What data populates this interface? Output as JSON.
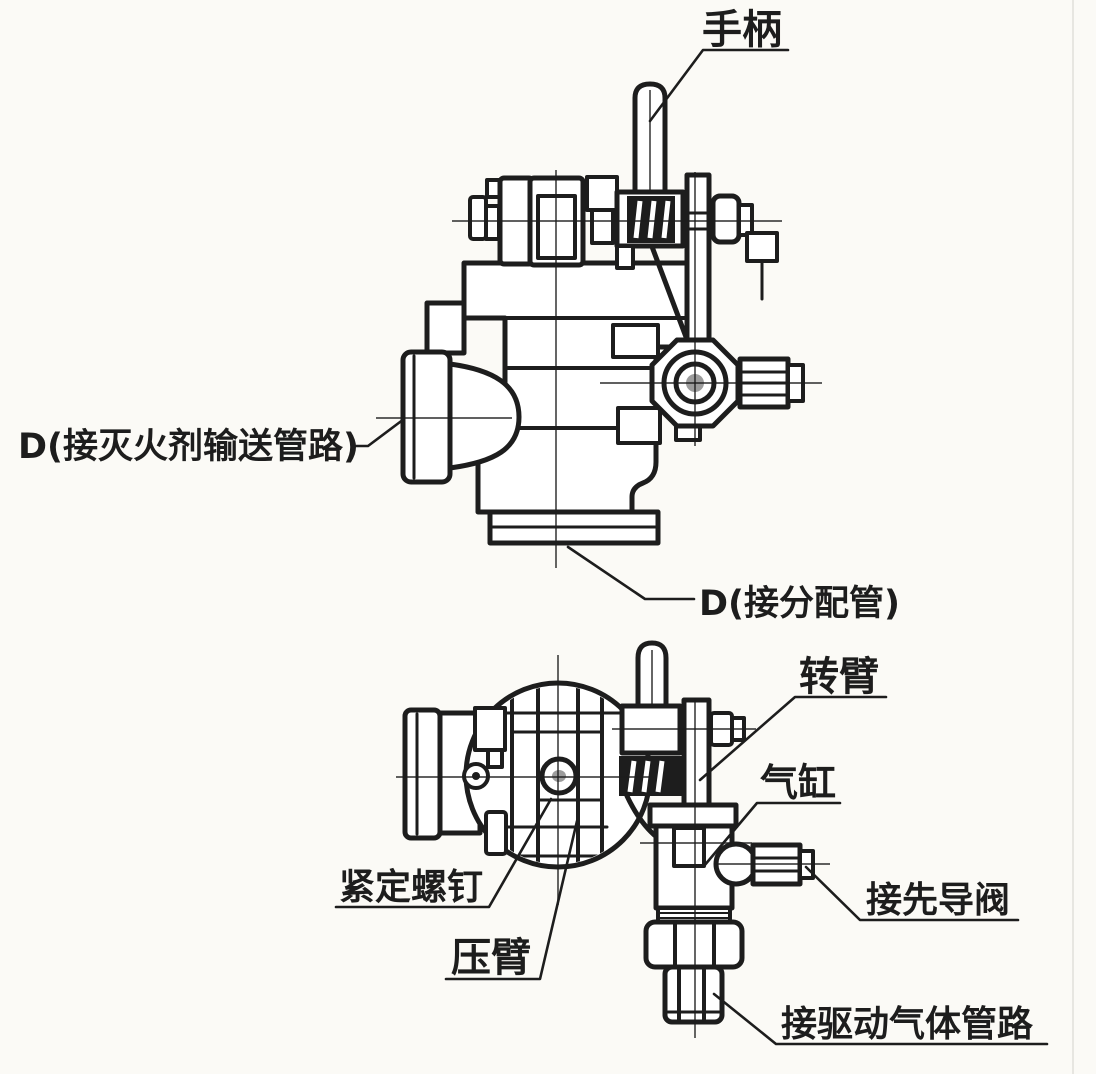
{
  "diagram": {
    "type": "technical-drawing",
    "colors": {
      "ink": "#1d1d1d",
      "paper": "#fbfaf6",
      "gray": "#9c9c9c"
    },
    "labels": {
      "handle": "手柄",
      "port_main": "D(接灭火剂输送管路)",
      "port_dist": "D(接分配管)",
      "rotating_arm": "转臂",
      "gas_cylinder": "气缸",
      "set_screw": "紧定螺钉",
      "pressure_arm": "压臂",
      "pilot_valve": "接先导阀",
      "driving_gas_line": "接驱动气体管路"
    }
  }
}
